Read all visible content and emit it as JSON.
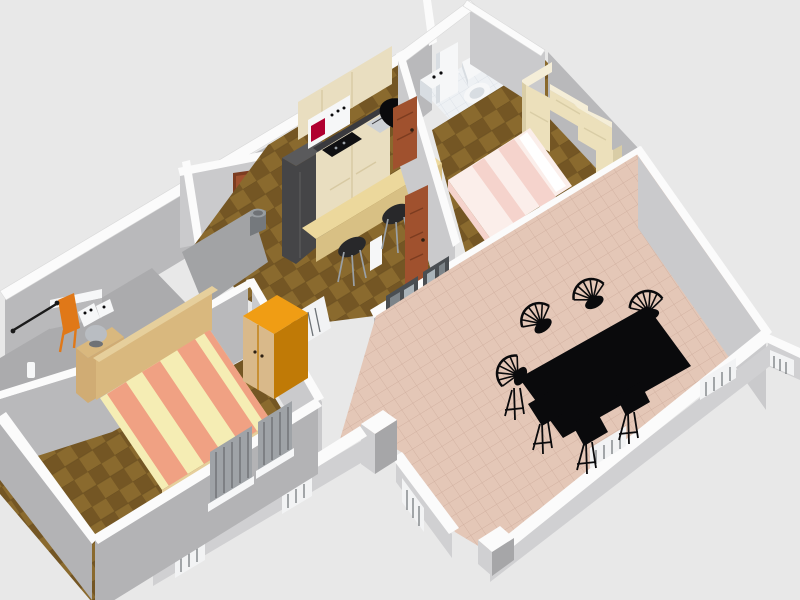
{
  "app": {
    "title": "3D apartment floor plan render",
    "view": "aerial perspective, rotated",
    "visible_text": ""
  },
  "scene": {
    "rooms": [
      {
        "name": "kitchen",
        "floor": "wood parquet",
        "furniture": [
          "tall-dark-unit",
          "base-cabinets",
          "counter-sink",
          "cooktop",
          "wall-oven-red-display",
          "upper-cabinets",
          "breakfast-bar",
          "bar-stool",
          "bar-stool",
          "waste-bin",
          "black-wall-oval"
        ]
      },
      {
        "name": "bathroom",
        "floor": "white tile",
        "furniture": [
          "washbasin-cabinet",
          "tall-cabinet",
          "toilet"
        ]
      },
      {
        "name": "bedroom-2",
        "floor": "wood parquet",
        "furniture": [
          "double-bed-pink",
          "bridge-wardrobe-cream"
        ]
      },
      {
        "name": "bedroom-1",
        "floor": "wood parquet",
        "furniture": [
          "striped-double-bed",
          "nightstand",
          "table-lamp",
          "orange-wardrobe",
          "window-shutters"
        ]
      },
      {
        "name": "utility-balcony",
        "floor": "concrete gray",
        "furniture": [
          "shelf-counter",
          "ironing-board",
          "drying-rod",
          "small-appliances",
          "bottle"
        ]
      },
      {
        "name": "hall",
        "floor": "wood parquet",
        "furniture": [
          "radiator",
          "interior-door",
          "interior-door",
          "interior-door"
        ]
      },
      {
        "name": "dining-living-room",
        "floor": "pink tile",
        "furniture": [
          "dining-table-black",
          "dining-chair",
          "dining-chair",
          "dining-chair",
          "dining-chair",
          "dining-chair",
          "dining-chair",
          "radiator-window-sills",
          "glass-door",
          "glass-door",
          "low-perimeter-walls",
          "entry-pillar"
        ]
      }
    ]
  },
  "colors": {
    "bg": "#e8e8e8",
    "cap": "#fbfbfb",
    "cap-edge": "#d9d9d9",
    "wall-light": "#cacacc",
    "wall-mid": "#b9b9bb",
    "wall-dark": "#a6a6a8",
    "wall-outer": "#b3b3b5",
    "low-face": "#d0d0d2",
    "wood-a": "#8a6a2e",
    "wood-b": "#745624",
    "wood-line": "#5f471d",
    "tile-a": "#e4c7b7",
    "tile-line": "#d2b1a1",
    "bath-a": "#eef1f4",
    "bath-line": "#d9dfe6",
    "splash-a": "#a9b3c0",
    "splash-line": "#96a1af",
    "floor-utility": "#ababad",
    "floor-corridor": "#a2a3a5",
    "door-brown": "#a0512e",
    "door-dark": "#7c3c20",
    "knob": "#2e2013",
    "fridge": "#454547",
    "fridge-top": "#5a5a5c",
    "cabinet": "#e9dec0",
    "cabinet-dark": "#d7c9a2",
    "counter": "#3a3a3e",
    "sink": "#cdd1d5",
    "cooktop": "#101012",
    "oven-red": "#b00030",
    "bar-top": "#ecd89c",
    "bar-front": "#d8c084",
    "stool": "#28282a",
    "stool-leg": "#9aa0a6",
    "bin": "#75797d",
    "bin-top": "#989da1",
    "white-obj": "#f6f7f8",
    "shadow-obj": "#d8dde2",
    "bed1-cream": "#f5edb4",
    "bed1-salmon": "#f0a183",
    "bed1-foot": "#e6cf9c",
    "headboard": "#d9b87e",
    "nightstand": "#d0ac74",
    "lamp": "#b9bdc2",
    "wardrobe1-top": "#f09d14",
    "wardrobe1-side": "#c07a06",
    "wardrobe1-front": "#d9b98a",
    "wardrobe2": "#ece0bb",
    "wardrobe2-side": "#d9cda6",
    "wardrobe2-top": "#f5eed8",
    "bed2-base": "#fbeeea",
    "bed2-stripe": "#f5d3cc",
    "pillow": "#ffffff",
    "orange-board": "#e07818",
    "rod": "#1a1a1a",
    "slat-bg": "#9fa3a7",
    "slat-line": "#6f7276",
    "radiator": "#f2f3f4",
    "radiator-slat": "#6d7276",
    "glass": "#7d8489",
    "glass-pane": "#aab3b9",
    "glass-frame": "#4a4e52",
    "black": "#0a0a0c"
  }
}
